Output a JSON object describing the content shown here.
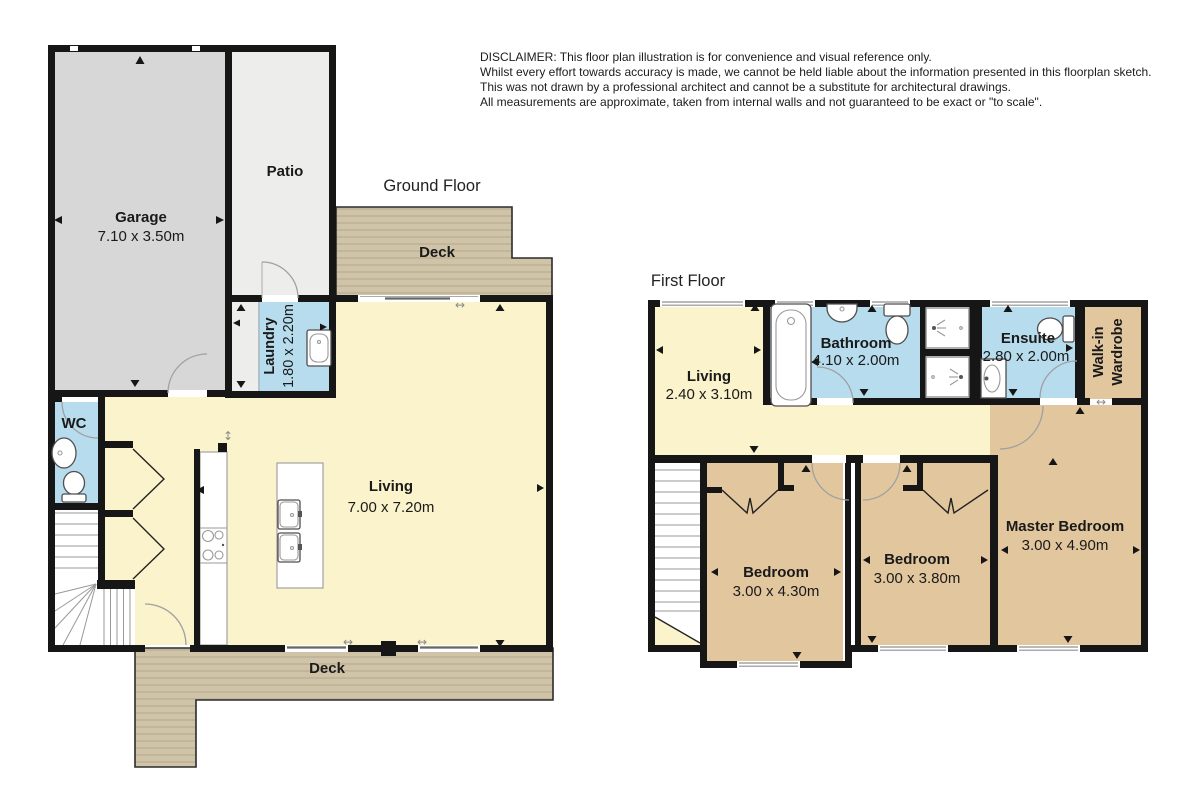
{
  "disclaimer": {
    "lines": [
      "DISCLAIMER: This floor plan illustration is for convenience and visual reference only.",
      "Whilst every effort towards accuracy is made, we cannot be held liable about the information presented in this floorplan sketch.",
      "This was not drawn by a professional architect and cannot be a substitute for architectural drawings.",
      "All measurements are approximate, taken from internal walls and not guaranteed to be exact or \"to scale\"."
    ]
  },
  "ground_floor": {
    "title": "Ground Floor",
    "garage": {
      "name": "Garage",
      "dims": "7.10 x 3.50m"
    },
    "patio": {
      "name": "Patio"
    },
    "deck_upper": {
      "name": "Deck"
    },
    "deck_lower": {
      "name": "Deck"
    },
    "laundry": {
      "name": "Laundry",
      "dims": "1.80 x 2.20m"
    },
    "wc": {
      "name": "WC"
    },
    "living": {
      "name": "Living",
      "dims": "7.00 x 7.20m"
    }
  },
  "first_floor": {
    "title": "First Floor",
    "living": {
      "name": "Living",
      "dims": "2.40 x 3.10m"
    },
    "bathroom": {
      "name": "Bathroom",
      "dims": "4.10 x 2.00m"
    },
    "ensuite": {
      "name": "Ensuite",
      "dims": "2.80 x 2.00m"
    },
    "walk_in_wardrobe": {
      "line1": "Walk-in",
      "line2": "Wardrobe"
    },
    "bedroom_left": {
      "name": "Bedroom",
      "dims": "3.00 x 4.30m"
    },
    "bedroom_middle": {
      "name": "Bedroom",
      "dims": "3.00 x 3.80m"
    },
    "master_bedroom": {
      "name": "Master Bedroom",
      "dims": "3.00 x 4.90m"
    }
  },
  "icons": {
    "sliding_door": "↔",
    "swing_door": "↕"
  },
  "colors": {
    "wall": "#161616",
    "room-yellow": "#faf3cb",
    "room-blue": "#b7dcee",
    "room-tan": "#e2c69e",
    "garage-gray": "#d7d7d7",
    "patio-gray": "#ededeb",
    "deck": "#cfc3a8",
    "deck-stripe": "#b9ac8f",
    "fixture-stroke": "#4f4f4f",
    "door-arc": "#a0a0a0",
    "window-line": "#8f8f8f",
    "text": "#1a1a1a"
  }
}
